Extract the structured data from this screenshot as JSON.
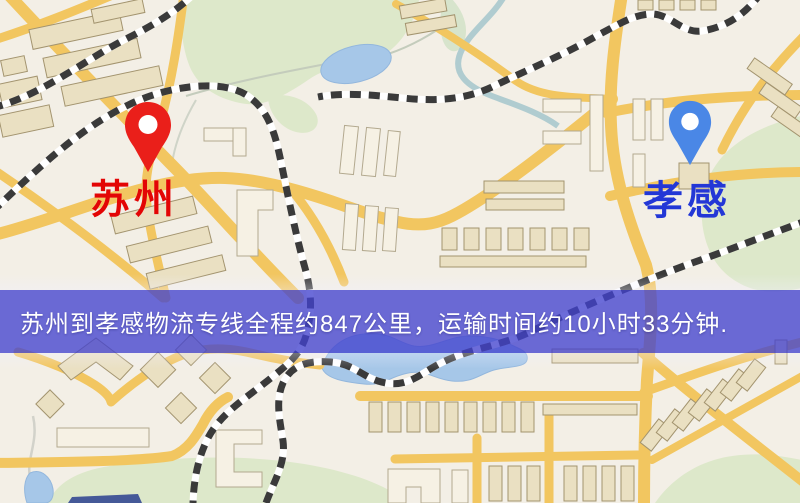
{
  "markers": {
    "origin": {
      "label": "苏州",
      "pin_color": "#ea1f1a",
      "label_color": "#e30505"
    },
    "destination": {
      "label": "孝感",
      "pin_color": "#4a87e6",
      "label_color": "#2337d6"
    }
  },
  "banner": {
    "text": "苏州到孝感物流专线全程约847公里，运输时间约10小时33分钟.",
    "background_color": "#4343ce",
    "text_color": "#ffffff"
  },
  "route": {
    "origin": "苏州",
    "destination": "孝感",
    "service": "物流专线",
    "distance": "约847公里",
    "duration": "约10小时33分钟"
  },
  "map_colors": {
    "background": "#f3efe6",
    "road": "#f2c660",
    "park": "#dde8ca",
    "water": "#a6c7e8",
    "railway": "#3a3a3a",
    "building_beige": "#eae0c2",
    "building_white": "#f6f1e4"
  }
}
